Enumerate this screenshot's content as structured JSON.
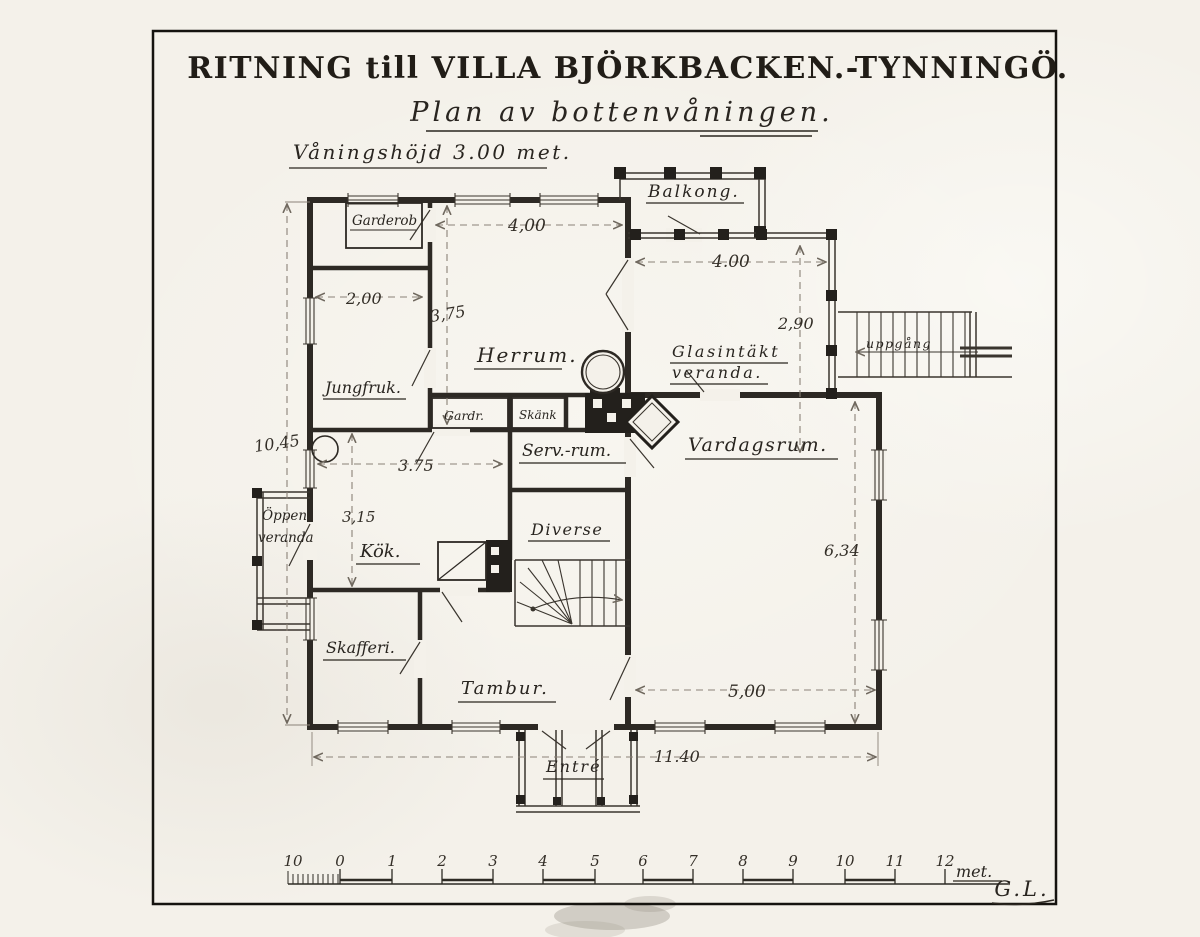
{
  "title": "RITNING till VILLA BJÖRKBACKEN.-TYNNINGÖ.",
  "subtitle": "Plan av bottenvåningen.",
  "note": "Våningshöjd 3.00 met.",
  "rooms": {
    "balkong": "Balkong.",
    "garderob": "Garderob",
    "herrum": "Herrum.",
    "jungfruk": "Jungfruk.",
    "gardr": "Gardr.",
    "skank": "Skänk",
    "glasintakt_line1": "Glasintäkt",
    "glasintakt_line2": "veranda.",
    "uppgang": "uppgång",
    "servrum": "Serv.-rum.",
    "vardagsrum": "Vardagsrum.",
    "oppen_line1": "Öppen",
    "oppen_line2": "veranda",
    "kok": "Kök.",
    "diverse": "Diverse",
    "skafferi": "Skafferi.",
    "tambur": "Tambur.",
    "entre": "Entré"
  },
  "dimensions": {
    "herrum_width": "4,00",
    "jungfru_width": "2,00",
    "herrum_depth": "3,75",
    "veranda_width": "4.00",
    "veranda_depth": "2,90",
    "house_depth": "10,45",
    "kok_width": "3.75",
    "kok_depth": "3,15",
    "vardagsrum_depth": "6,34",
    "vardagsrum_width": "5,00",
    "house_width": "11.40"
  },
  "scale_bar": {
    "labels": [
      "10",
      "0",
      "1",
      "2",
      "3",
      "4",
      "5",
      "6",
      "7",
      "8",
      "9",
      "10",
      "11",
      "12"
    ],
    "unit": "met."
  },
  "signature": "G.L."
}
